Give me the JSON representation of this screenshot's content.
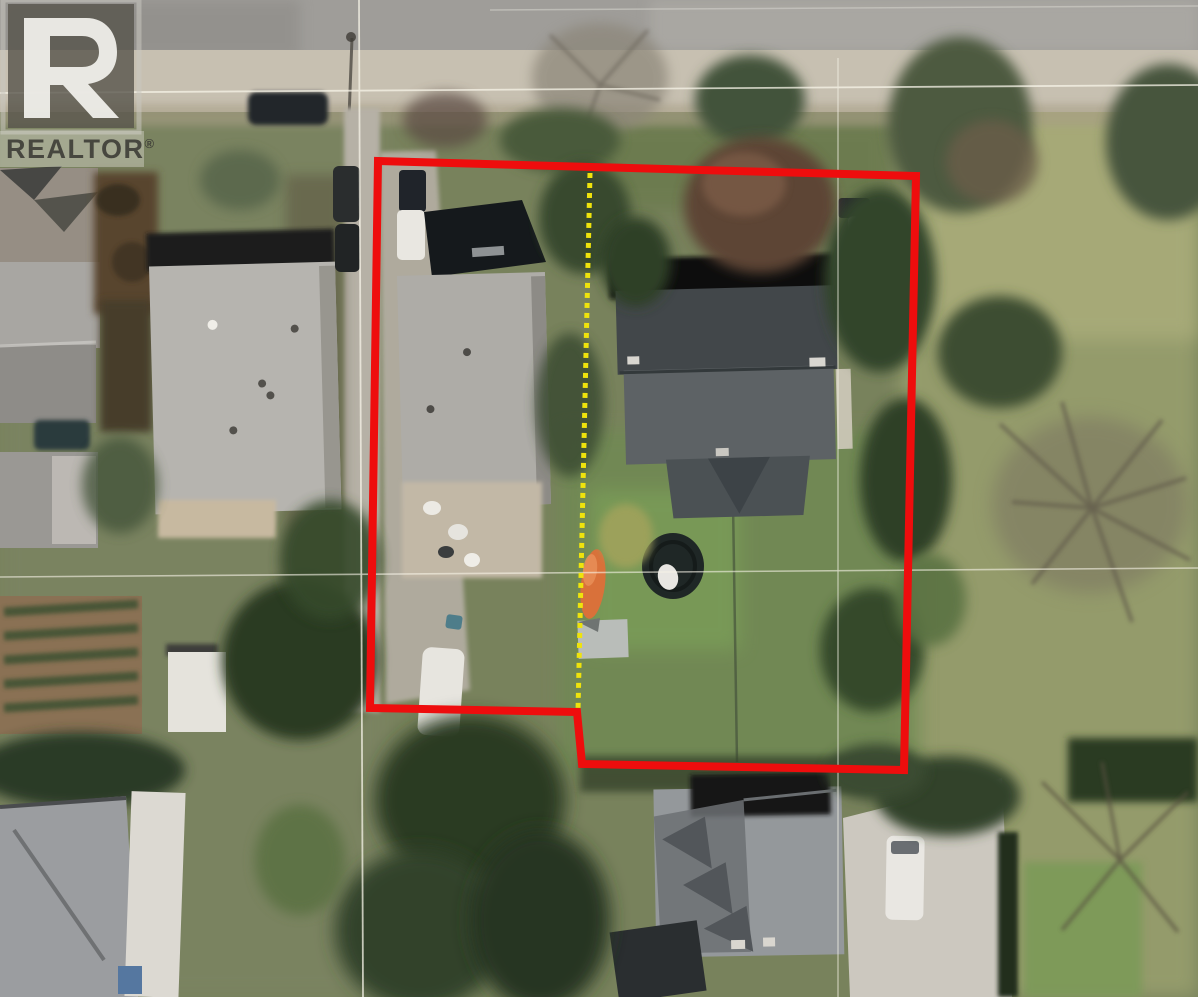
{
  "watermark": {
    "logo_letter": "R",
    "label": "REALTOR",
    "registered_mark": "®"
  },
  "colors": {
    "boundary_red": "#ee0d0d",
    "divider_yellow": "#efe30c",
    "gridline_white": "#f7f4e8",
    "logo_box": "#555249",
    "logo_box_frame": "#c9c6bf",
    "logo_mark_white": "#f4f3ef",
    "logo_text_dark": "#3b3a35",
    "logo_text_band": "#d8d5cc"
  },
  "annotations": {
    "parcel_boundary_path": "M378,161 L916,176 L904,770 L582,764 L577,712 L370,708 Z",
    "parcel_boundary_width": "8",
    "divider_path": "M590,173 L578,711",
    "divider_width": "5",
    "divider_dash": "5,5",
    "gridline_h1_path": "M0,93 L1198,85",
    "gridline_h2_path": "M0,577 L1198,568",
    "gridline_v1_path": "M359,0 L363,997",
    "gridline_v2_path": "M838,58 L838,997",
    "road_lane_mark_path": "M490,10 L1198,6"
  }
}
